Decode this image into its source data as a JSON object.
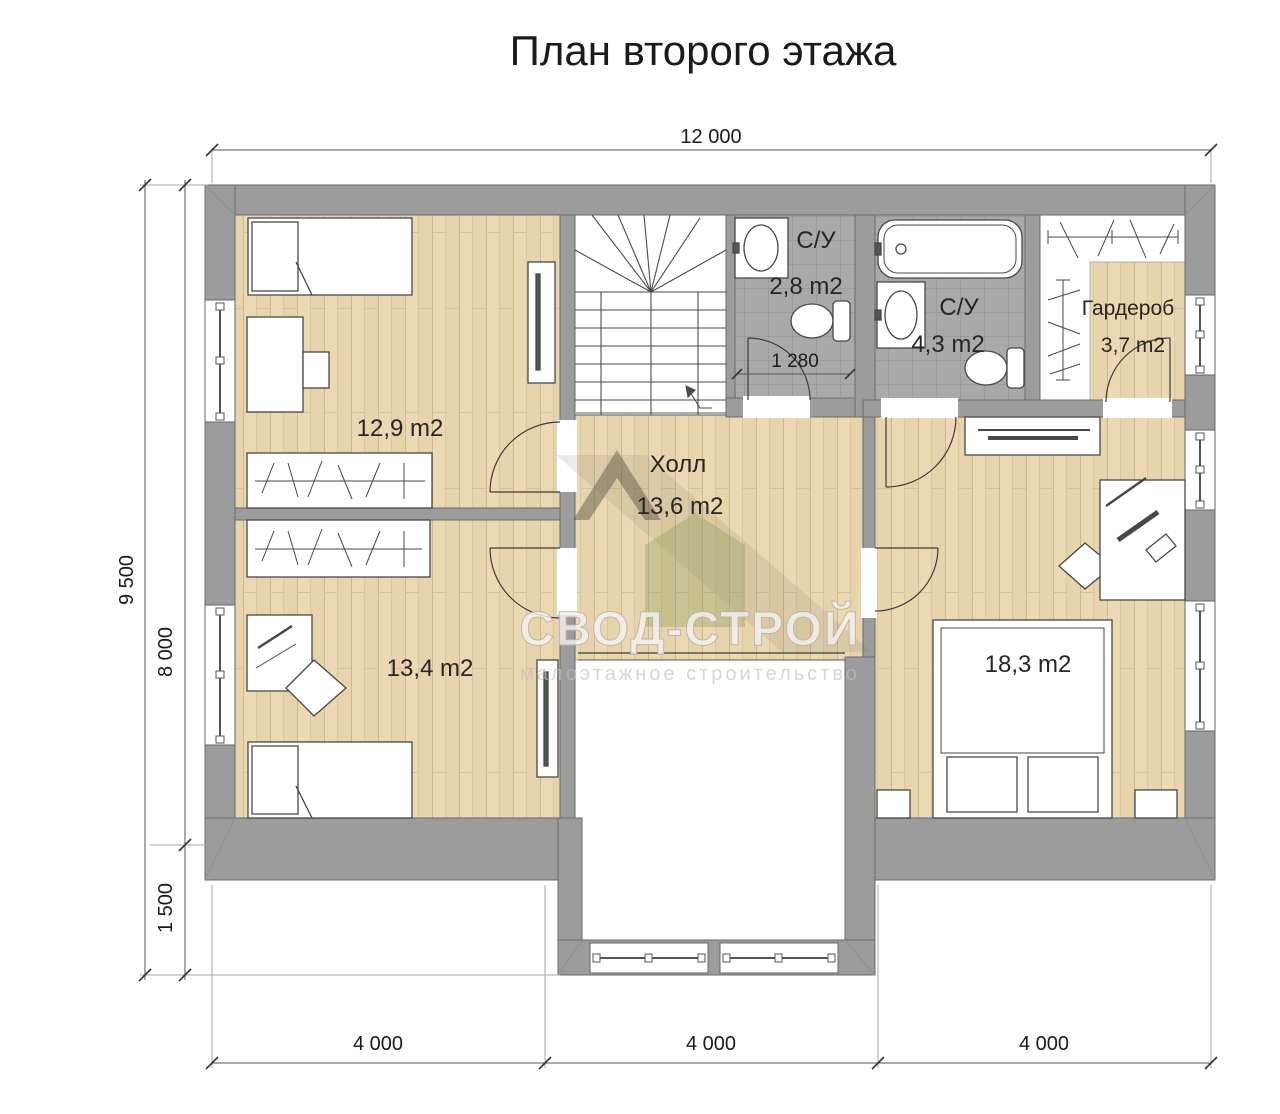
{
  "title": "План второго этажа",
  "watermark": {
    "brand": "СВОД-СТРОЙ",
    "tagline": "малоэтажное строительство"
  },
  "dimensions": {
    "top": "12 000",
    "left_total": "9 500",
    "left_main": "8 000",
    "left_extension": "1 500",
    "bottom": [
      "4 000",
      "4 000",
      "4 000"
    ],
    "bathroom_width": "1 280"
  },
  "rooms": [
    {
      "id": "bedroom-1",
      "area": "12,9 m2"
    },
    {
      "id": "bedroom-2",
      "area": "13,4 m2"
    },
    {
      "id": "hall",
      "name": "Холл",
      "area": "13,6 m2"
    },
    {
      "id": "bathroom-1",
      "name": "С/У",
      "area": "2,8 m2"
    },
    {
      "id": "bathroom-2",
      "name": "С/У",
      "area": "4,3 m2"
    },
    {
      "id": "wardrobe",
      "name": "Гардероб",
      "area": "3,7 m2"
    },
    {
      "id": "bedroom-master",
      "area": "18,3 m2"
    }
  ],
  "colors": {
    "wall": "#9c9c9c",
    "wood": "#ecd9b4",
    "tile": "#a9a9a9",
    "line": "#3c3c3c"
  }
}
